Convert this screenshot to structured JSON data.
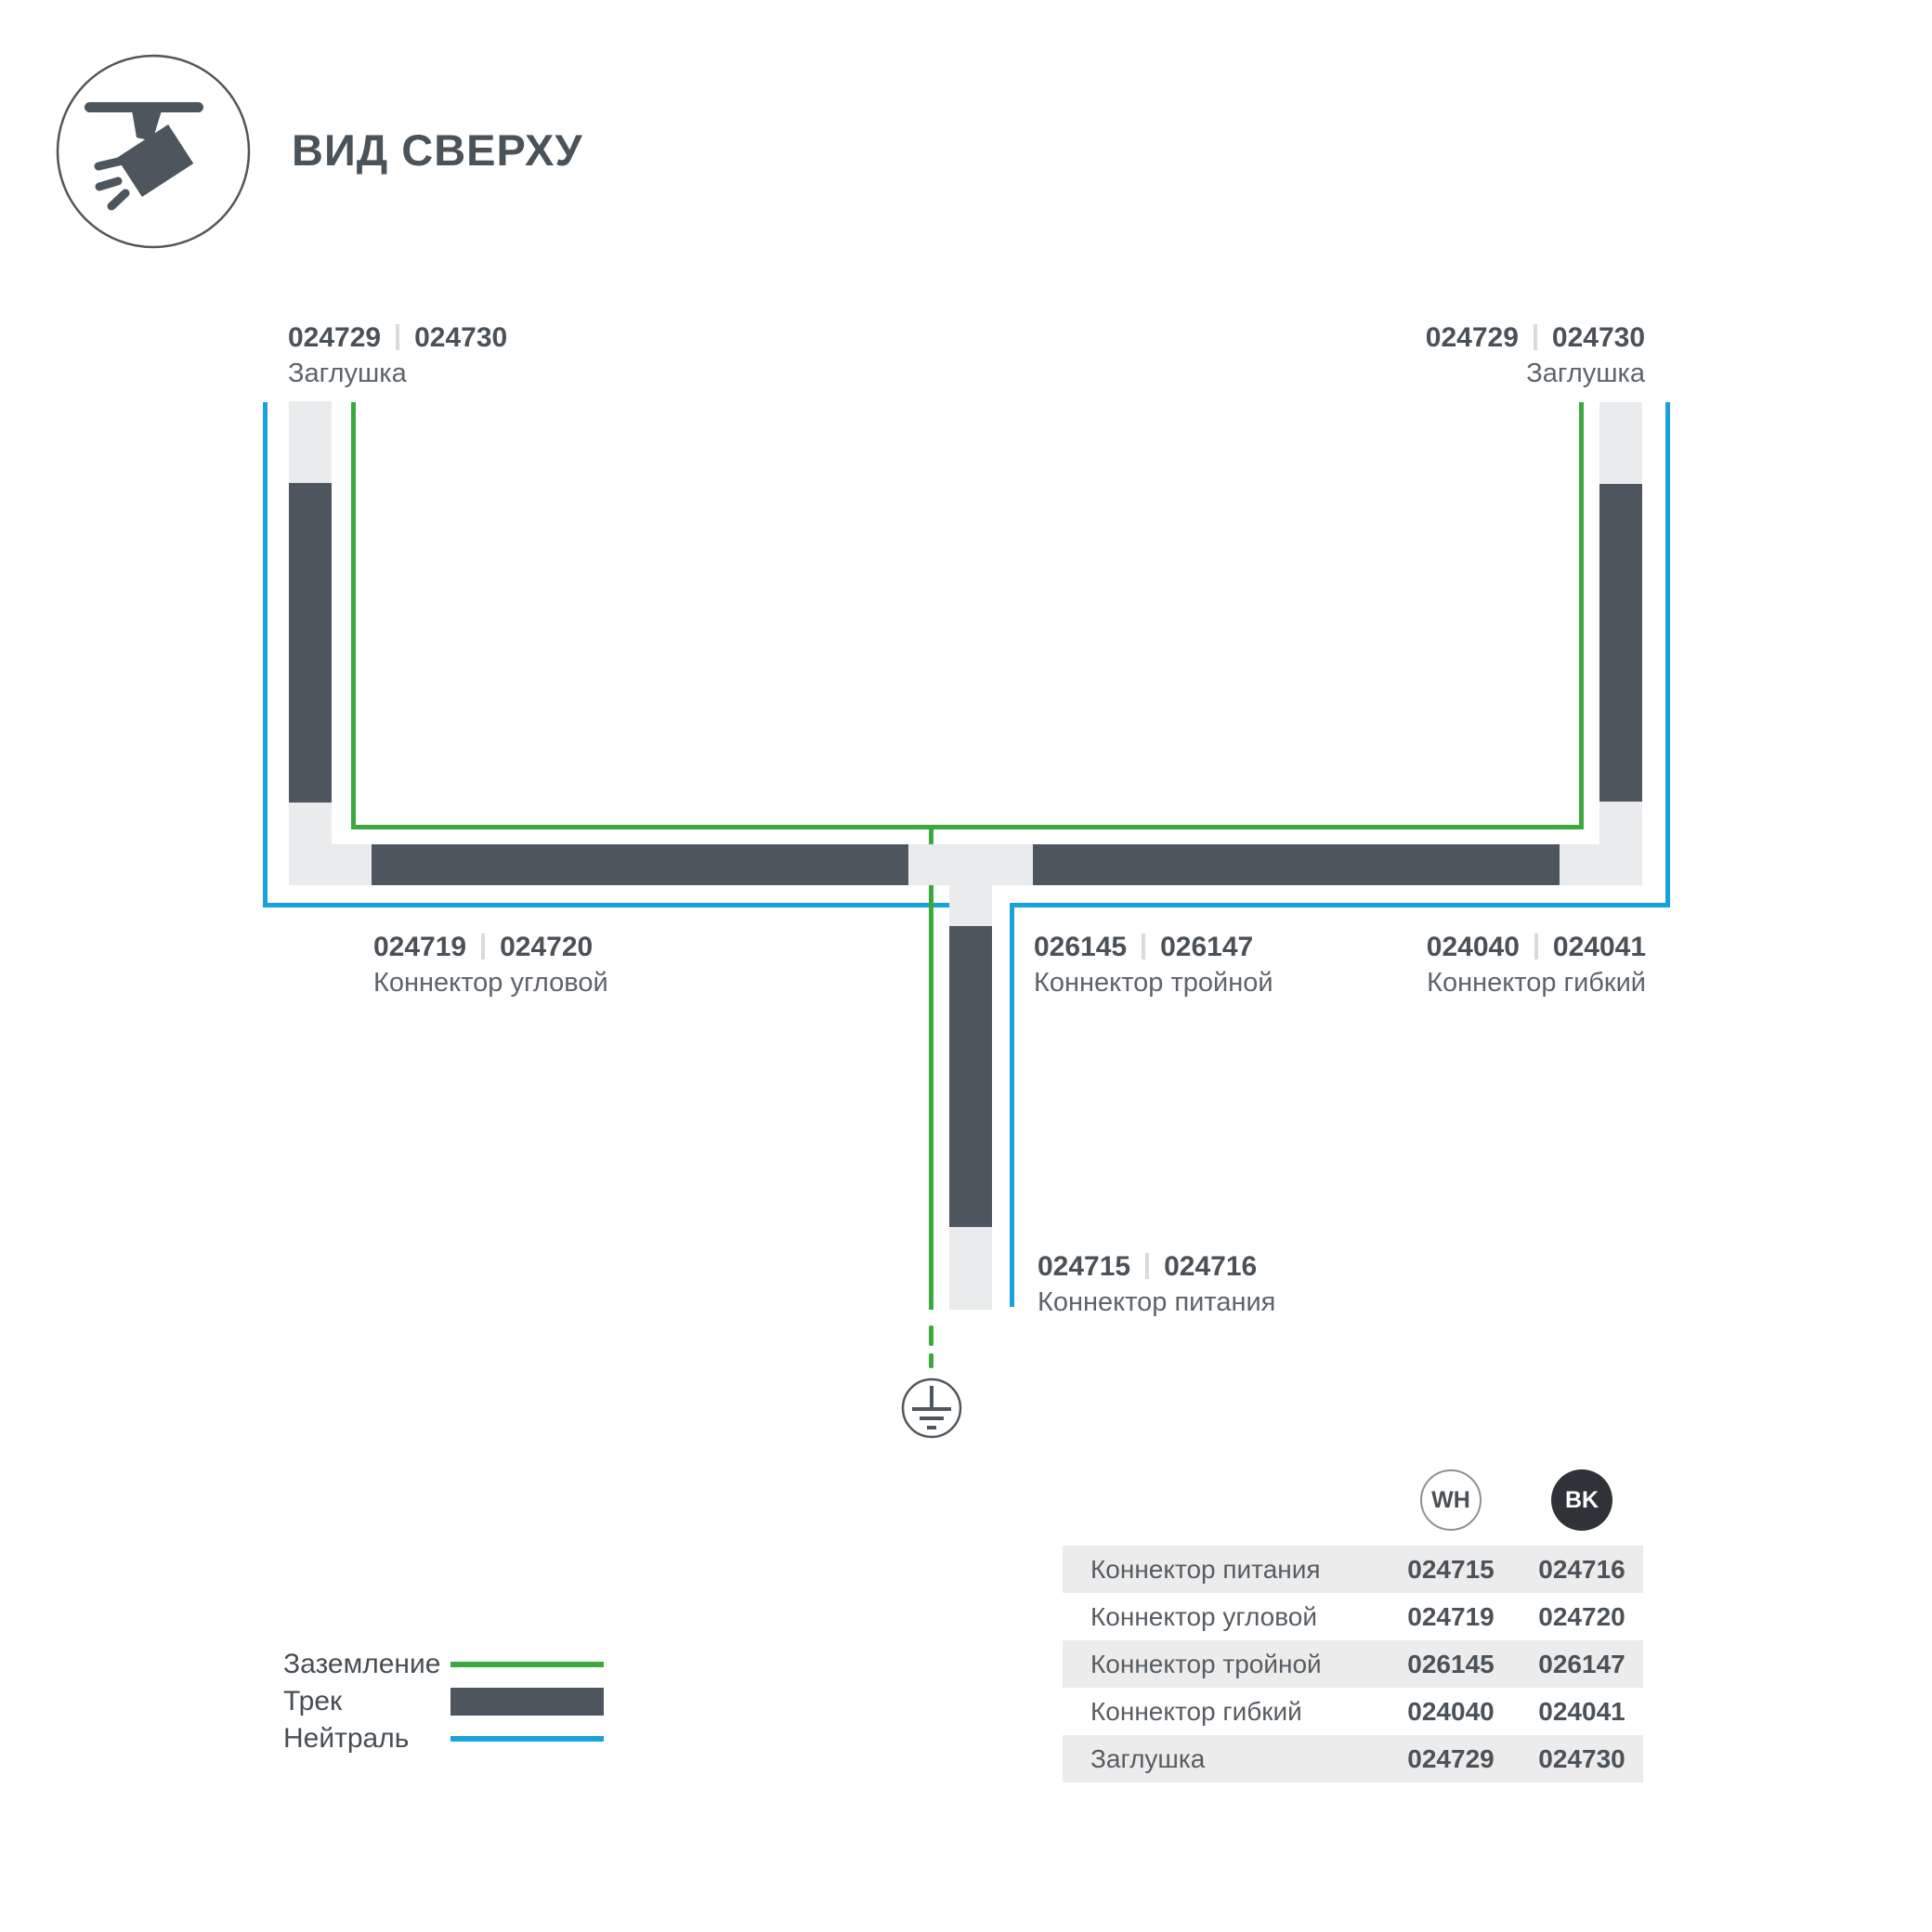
{
  "header": {
    "title": "ВИД СВЕРХУ",
    "icon": "track-spotlight"
  },
  "diagram": {
    "labels": {
      "cap_left": {
        "wh": "024729",
        "bk": "024730",
        "name": "Заглушка"
      },
      "cap_right": {
        "wh": "024729",
        "bk": "024730",
        "name": "Заглушка"
      },
      "corner": {
        "wh": "024719",
        "bk": "024720",
        "name": "Коннектор угловой"
      },
      "triple": {
        "wh": "026145",
        "bk": "026147",
        "name": "Коннектор тройной"
      },
      "flex": {
        "wh": "024040",
        "bk": "024041",
        "name": "Коннектор гибкий"
      },
      "power": {
        "wh": "024715",
        "bk": "024716",
        "name": "Коннектор питания"
      }
    },
    "colors": {
      "track": "#4d565e",
      "connector": "#e9ebec",
      "ground_line": "#3aaa3e",
      "neutral_line": "#18a1dc"
    },
    "ground_symbol": "earth-ground"
  },
  "legend": {
    "items": [
      {
        "label": "Заземление",
        "type": "ground-line"
      },
      {
        "label": "Трек",
        "type": "track-bar"
      },
      {
        "label": "Нейтраль",
        "type": "neutral-line"
      }
    ]
  },
  "table": {
    "columns": [
      {
        "code": "WH"
      },
      {
        "code": "BK"
      }
    ],
    "rows": [
      {
        "name": "Коннектор питания",
        "wh": "024715",
        "bk": "024716"
      },
      {
        "name": "Коннектор угловой",
        "wh": "024719",
        "bk": "024720"
      },
      {
        "name": "Коннектор тройной",
        "wh": "026145",
        "bk": "026147"
      },
      {
        "name": "Коннектор гибкий",
        "wh": "024040",
        "bk": "024041"
      },
      {
        "name": "Заглушка",
        "wh": "024729",
        "bk": "024730"
      }
    ]
  }
}
